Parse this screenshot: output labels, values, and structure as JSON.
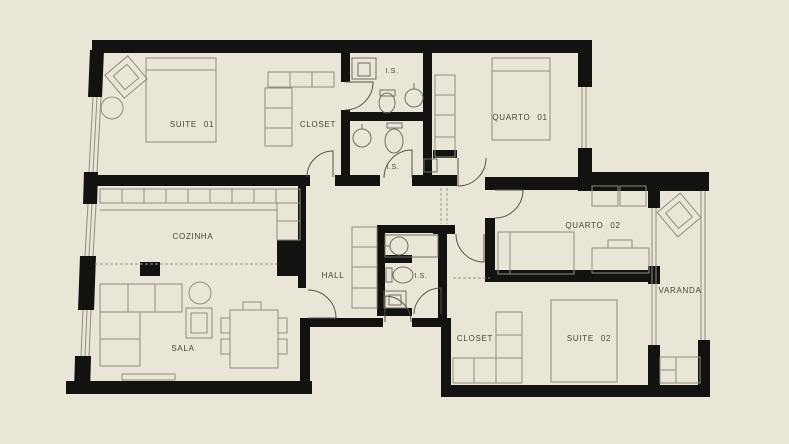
{
  "title": "apartment-floor-plan",
  "canvas": {
    "background": "#e9e6d8",
    "wall_color": "#121210",
    "furniture_line_color": "#8f8c80",
    "label_color": "#45443c"
  },
  "plan": {
    "rooms": [
      {
        "id": "suite-01",
        "label": "SUITE 01",
        "x": 192,
        "y": 127,
        "fs": 8
      },
      {
        "id": "closet-top",
        "label": "CLOSET",
        "x": 318,
        "y": 127,
        "fs": 8
      },
      {
        "id": "is-top",
        "label": "I.S.",
        "x": 392,
        "y": 73,
        "fs": 7
      },
      {
        "id": "is-mid",
        "label": "I.S.",
        "x": 393,
        "y": 169,
        "fs": 7
      },
      {
        "id": "quarto-01",
        "label": "QUARTO 01",
        "x": 520,
        "y": 120,
        "fs": 8
      },
      {
        "id": "cozinha",
        "label": "COZINHA",
        "x": 193,
        "y": 239,
        "fs": 8
      },
      {
        "id": "quarto-02",
        "label": "QUARTO 02",
        "x": 593,
        "y": 228,
        "fs": 8
      },
      {
        "id": "hall",
        "label": "HALL",
        "x": 333,
        "y": 278,
        "fs": 8
      },
      {
        "id": "is-hall",
        "label": "I.S.",
        "x": 421,
        "y": 278,
        "fs": 7
      },
      {
        "id": "varanda",
        "label": "VARANDA",
        "x": 680,
        "y": 293,
        "fs": 8
      },
      {
        "id": "sala",
        "label": "SALA",
        "x": 183,
        "y": 351,
        "fs": 8
      },
      {
        "id": "closet-bottom",
        "label": "CLOSET",
        "x": 475,
        "y": 341,
        "fs": 8
      },
      {
        "id": "suite-02",
        "label": "SUITE 02",
        "x": 589,
        "y": 341,
        "fs": 8
      }
    ]
  }
}
